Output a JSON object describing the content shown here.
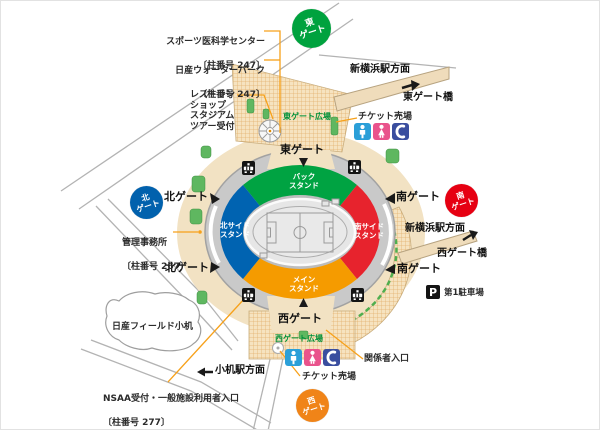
{
  "annotations": {
    "sports_med_center": {
      "name": "スポーツ医科学センター",
      "pillar": "〔柱番号 247〕"
    },
    "water_park": {
      "name": "日産ウォーターパーク",
      "pillar": "〔柱番号 247〕"
    },
    "restaurant_block": "レストラン\nショップ\nスタジアム\nツアー受付",
    "admin_office": {
      "name": "管理事務所",
      "pillar": "〔柱番号 267〕"
    },
    "nsaa_reception": {
      "name": "NSAA受付・一般施設利用者入口",
      "pillar": "〔柱番号 277〕"
    },
    "nissan_field_kozukue": "日産フィールド小机",
    "staff_entrance": "関係者入口",
    "ticket_office_top": "チケット売場",
    "ticket_office_bottom": "チケット売場",
    "parking_label": "第1駐車場",
    "parking_symbol": "P"
  },
  "directions": {
    "shin_yokohama_top": "新横浜駅方面",
    "east_gate_bridge": "東ゲート橋",
    "shin_yokohama_right": "新横浜駅方面",
    "west_gate_bridge": "西ゲート橋",
    "kozukue_station": "小机駅方面"
  },
  "gates": {
    "badge_east": "東\nゲート",
    "badge_north": "北\nゲート",
    "badge_south": "南\nゲート",
    "badge_west": "西\nゲート",
    "label_east": "東ゲート",
    "label_west": "西ゲート",
    "label_north_upper": "北ゲート",
    "label_north_lower": "北ゲート",
    "label_south_upper": "南ゲート",
    "label_south_lower": "南ゲート"
  },
  "stands": {
    "back": "バック\nスタンド",
    "north_side": "北サイド\nスタンド",
    "south_side": "南サイド\nスタンド",
    "main": "メイン\nスタンド"
  },
  "plazas": {
    "east": "東ゲート広場",
    "west": "西ゲート広場"
  },
  "colors": {
    "stand_back": "#00a342",
    "stand_north_side": "#0063b1",
    "stand_south_side": "#e7232d",
    "stand_main": "#f59b00",
    "badge_east": "#00a23e",
    "badge_north": "#0161ad",
    "badge_south": "#e60012",
    "badge_west": "#f08418",
    "plaza_text": "#00913a",
    "leader_line": "#f7a11a",
    "restroom_male": "#2b9fd8",
    "restroom_female": "#e9538c",
    "phone": "#3a4e9f"
  }
}
